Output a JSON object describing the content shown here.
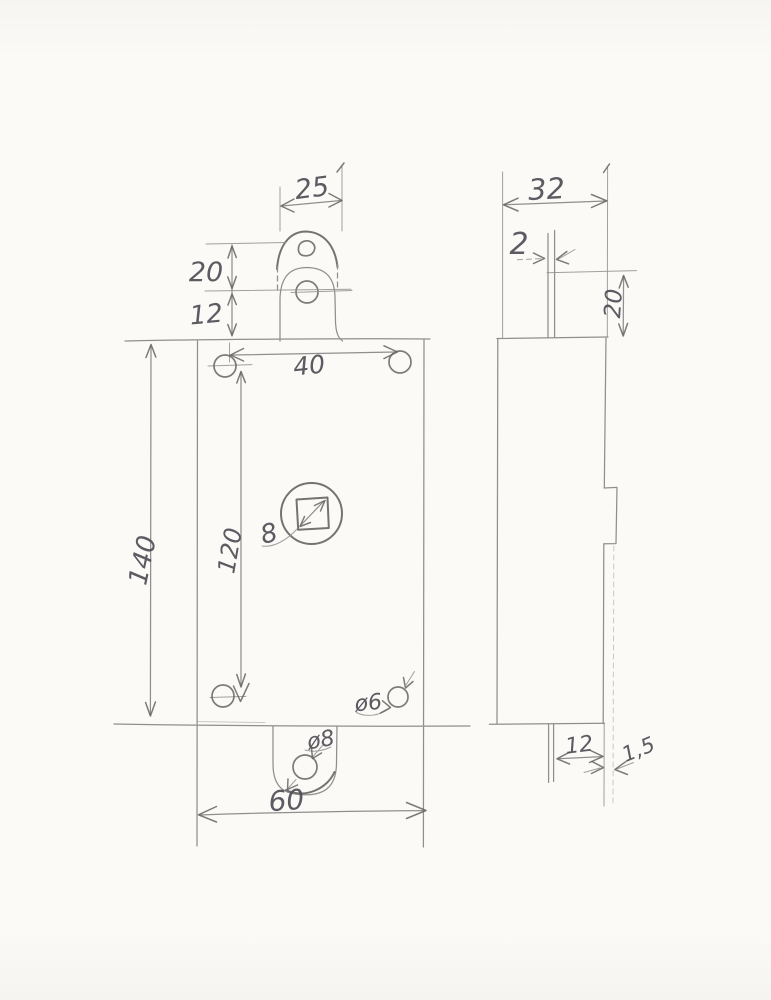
{
  "colors": {
    "paper": "#fbfaf7",
    "pencil": "#8f8f8f",
    "pencil-dark": "#666462",
    "ink": "#4e4e55"
  },
  "front_view": {
    "dim_tab_width": "25",
    "dim_upper_hole_gap": "20",
    "dim_lower_hole_gap": "12",
    "dim_top_holes_span": "40",
    "dim_body_height": "140",
    "dim_holes_vertical_span": "120",
    "dim_spindle_square": "8",
    "dim_bottom_right_hole": "ø6",
    "dim_bottom_tab_hole": "ø8",
    "dim_body_width": "60"
  },
  "side_view": {
    "dim_body_depth": "32",
    "dim_bar_thickness": "2",
    "dim_bar_top_length": "20",
    "dim_bar_bottom_offset": "12",
    "dim_plate_thickness": "1,5"
  }
}
